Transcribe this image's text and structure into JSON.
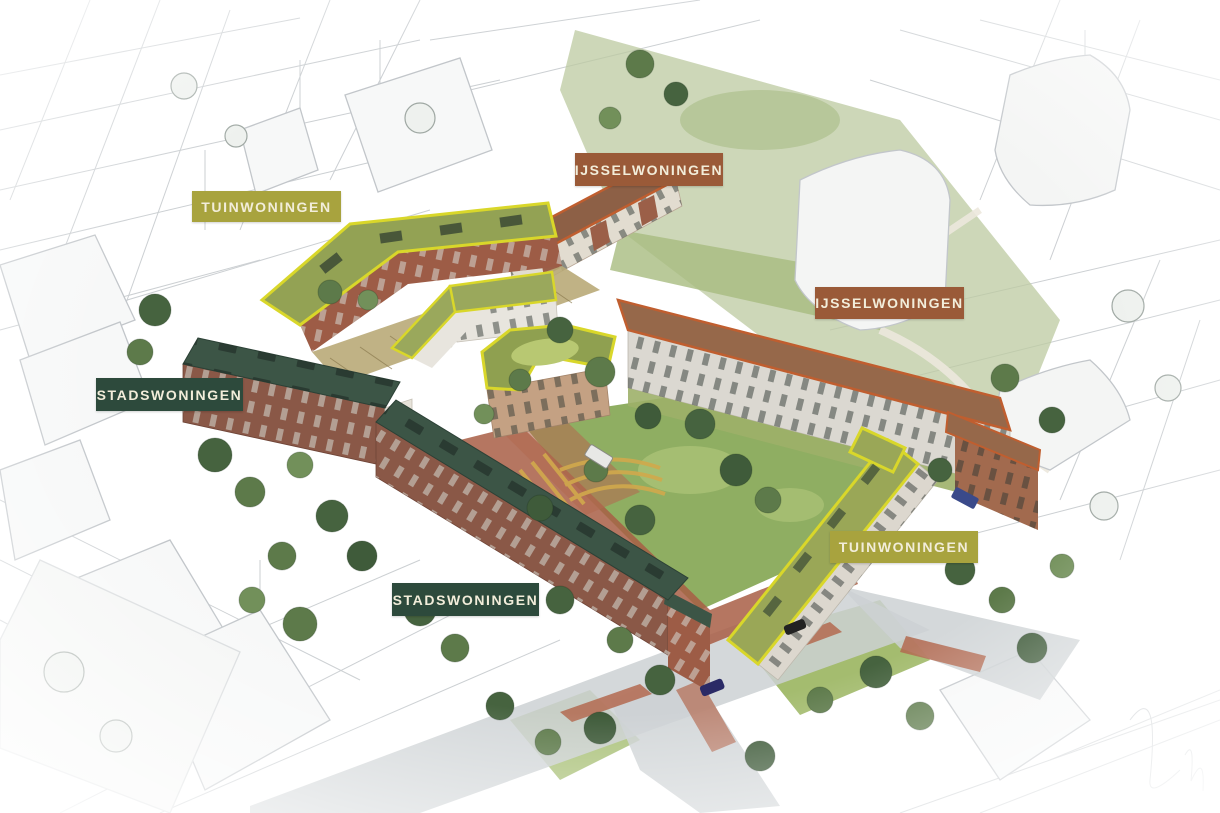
{
  "labels": [
    {
      "text": "TUINWONINGEN",
      "color": "#a8a33e",
      "text_color": "#f2edda"
    },
    {
      "text": "IJSSELWONINGEN",
      "color": "#9a5a38",
      "text_color": "#f2edda"
    },
    {
      "text": "IJSSELWONINGEN",
      "color": "#9a5a38",
      "text_color": "#f2edda"
    },
    {
      "text": "STADSWONINGEN",
      "color": "#2d4a3c",
      "text_color": "#f2edda"
    },
    {
      "text": "STADSWONINGEN",
      "color": "#2d4a3c",
      "text_color": "#f2edda"
    },
    {
      "text": "TUINWONINGEN",
      "color": "#a8a33e",
      "text_color": "#f2edda"
    }
  ],
  "building_types": [
    {
      "name": "TUINWONINGEN",
      "badge_color": "#a8a33e",
      "outline_color": "#d9d72a",
      "roof_color": "#93a254"
    },
    {
      "name": "IJSSELWONINGEN",
      "badge_color": "#9a5a38",
      "outline_color": "#c05e2f",
      "roof_color": "#8d6046"
    },
    {
      "name": "STADSWONINGEN",
      "badge_color": "#2d4a3c",
      "outline_color": "#2d4a3c",
      "roof_color": "#3c5546"
    }
  ]
}
